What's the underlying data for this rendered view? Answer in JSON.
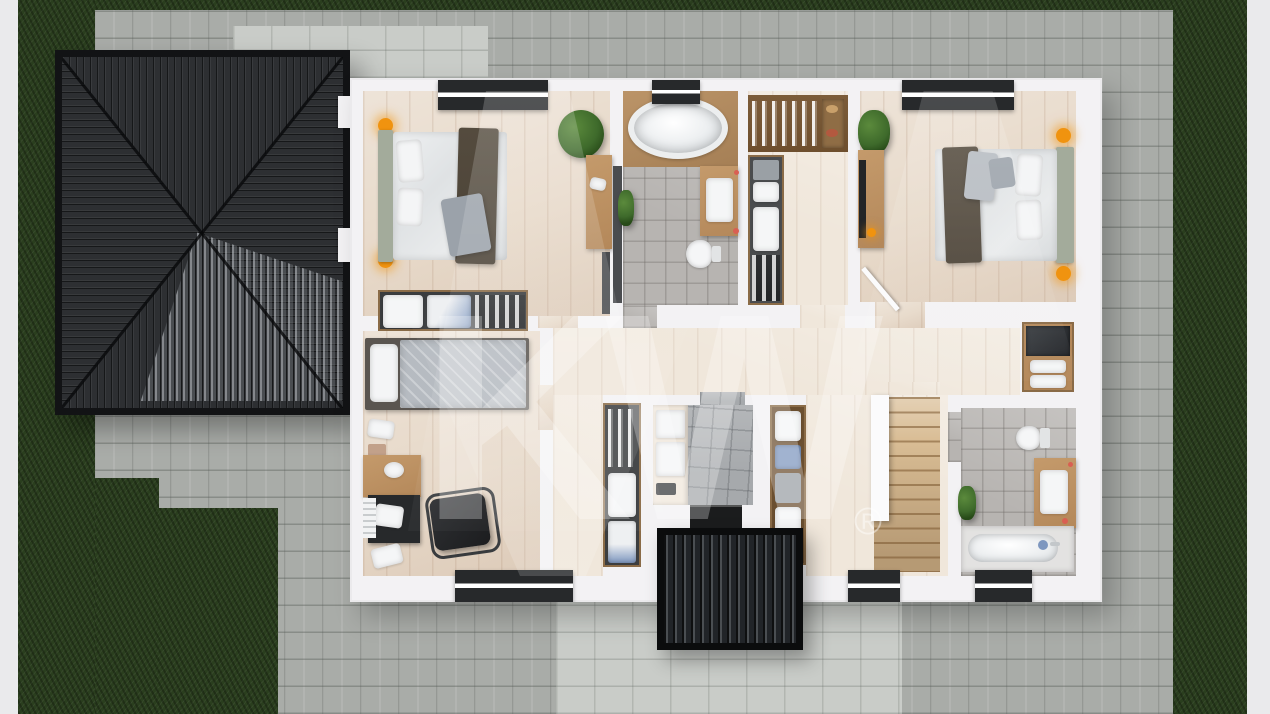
{
  "watermark": {
    "text": "KW",
    "registered": "®"
  },
  "palette": {
    "edge": "#eaeaec",
    "grass": "#2a3e1e",
    "paver": "#a9aca8",
    "paverLight": "#c9ccc8",
    "roof": "#2d2f32",
    "roofEdge": "#121315",
    "wall": "#f3f2f4",
    "wood": "#e7d9c9",
    "woodLight": "#f0e7db",
    "tile": "#b7b4b1",
    "tileCool": "#a6a9ac",
    "stair": "#d9bd95",
    "furnWood": "#b4885a",
    "furnWoodDark": "#6e4f2e",
    "dark": "#27292b",
    "fixture": "#f5f6f7",
    "headboard": "#a3ab9b",
    "throw": "#4c4337",
    "blanket": "#9ba2aa",
    "bedspread": "#b6bbc1",
    "lamp": "#f0930f",
    "plant": "#3e6a2b",
    "red": "#d95f52",
    "blue": "#7e97bf",
    "matDark": "#1b1c1d",
    "glassDark": "#4a4c4f",
    "watermark": "rgba(255,255,255,0.27)",
    "regmark": "rgba(255,255,255,0.45)"
  }
}
